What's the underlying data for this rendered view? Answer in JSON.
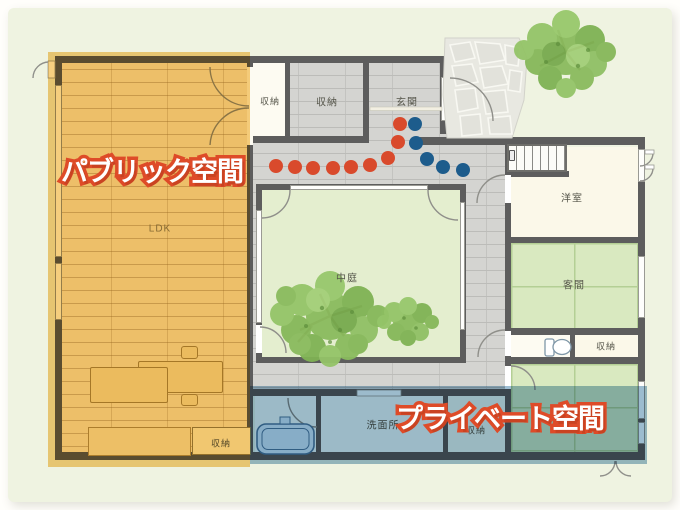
{
  "zones": {
    "public": {
      "label": "パブリック空間",
      "overlay_color": "#f0b232",
      "text_color": "#ffffff",
      "outline_color": "#de4b28"
    },
    "private": {
      "label": "プライベート空間",
      "overlay_color": "#4b86ad",
      "text_color": "#ffffff",
      "outline_color": "#de4b28"
    }
  },
  "rooms": {
    "ldk": "LDK",
    "storage_nw": "収納",
    "storage_n": "収納",
    "genkan": "玄関",
    "youshitsu": "洋室",
    "kyakuma": "客間",
    "nakaniwa": "中庭",
    "storage_e": "収納",
    "senmenjo": "洗面所",
    "storage_s": "収納",
    "storage_ldk": "収納"
  },
  "flow": {
    "red": {
      "color": "#d94a2c",
      "points": [
        [
          276,
          166
        ],
        [
          295,
          167
        ],
        [
          313,
          168
        ],
        [
          333,
          168
        ],
        [
          351,
          167
        ],
        [
          370,
          165
        ],
        [
          388,
          158
        ],
        [
          398,
          142
        ],
        [
          400,
          124
        ]
      ]
    },
    "blue": {
      "color": "#1d5c8c",
      "points": [
        [
          415,
          124
        ],
        [
          416,
          143
        ],
        [
          427,
          159
        ],
        [
          443,
          167
        ],
        [
          463,
          170
        ]
      ]
    }
  }
}
